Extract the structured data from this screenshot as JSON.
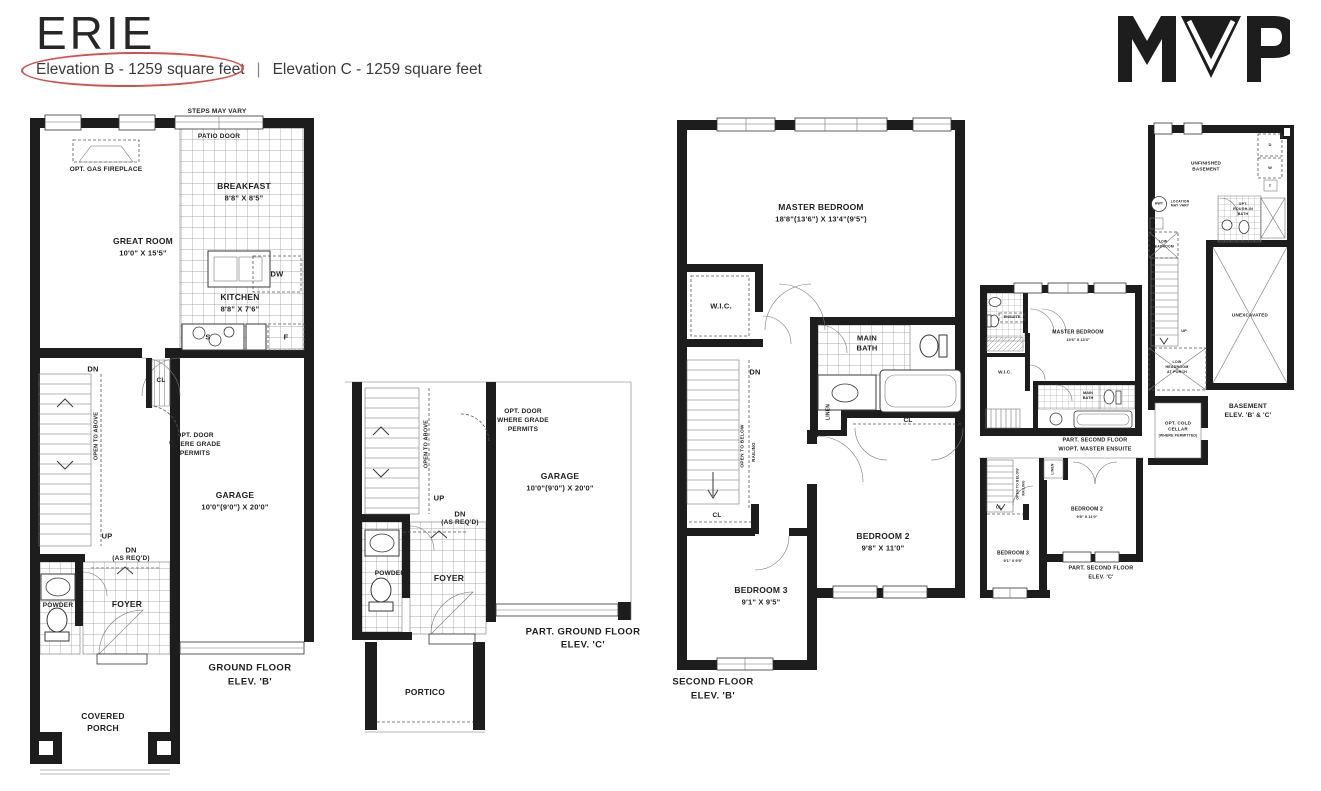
{
  "header": {
    "title": "ERIE",
    "elevation_b": "Elevation B - 1259 square feet",
    "divider": "|",
    "elevation_c": "Elevation C - 1259 square feet"
  },
  "logo": {
    "text": "MVP"
  },
  "common": {
    "dn": "DN",
    "up": "UP",
    "cl": "CL",
    "dw": "DW",
    "f": "F",
    "s": "S",
    "as_reqd": "(AS REQ'D)",
    "open_to_above": "OPEN TO ABOVE",
    "open_to_below": "OPEN TO BELOW",
    "railing": "RAILING",
    "linen": "LINEN",
    "powder": "POWDER",
    "foyer": "FOYER",
    "wic": "W.I.C.",
    "opt_door_1": "OPT. DOOR",
    "opt_door_2": "WHERE GRADE",
    "opt_door_3": "PERMITS",
    "garage": "GARAGE",
    "garage_dims": "10'0\"(9'0\") X 20'0\"",
    "main": "MAIN",
    "bath": "BATH",
    "bedroom2": "BEDROOM 2",
    "bedroom2_dims": "9'8\" X 11'0\"",
    "bedroom3": "BEDROOM 3",
    "bedroom3_dims": "9'1\" X 9'5\""
  },
  "plans": {
    "ground_b": {
      "steps_may_vary": "STEPS MAY VARY",
      "patio_door": "PATIO DOOR",
      "opt_gas_fireplace": "OPT. GAS FIREPLACE",
      "breakfast": "BREAKFAST",
      "breakfast_dims": "8'8\" X 8'5\"",
      "great_room": "GREAT ROOM",
      "great_room_dims": "10'0\" X 15'5\"",
      "kitchen": "KITCHEN",
      "kitchen_dims": "8'8\" X 7'6\"",
      "covered_1": "COVERED",
      "covered_2": "PORCH",
      "caption_1": "GROUND FLOOR",
      "caption_2": "ELEV. 'B'"
    },
    "part_ground_c": {
      "portico": "PORTICO",
      "caption_1": "PART. GROUND FLOOR",
      "caption_2": "ELEV. 'C'"
    },
    "second_b": {
      "master": "MASTER BEDROOM",
      "master_dims": "18'8\"(13'6\") X 13'4\"(9'5\")",
      "caption_1": "SECOND FLOOR",
      "caption_2": "ELEV. 'B'"
    },
    "part_second_ens": {
      "ensuite": "ENSUITE",
      "glass_shower": "GLASS SHOWER",
      "master": "MASTER BEDROOM",
      "master_dims": "13'6\" X 13'4\"",
      "caption_1": "PART. SECOND FLOOR",
      "caption_2": "W/OPT. MASTER ENSUITE"
    },
    "part_second_c": {
      "caption_1": "PART. SECOND FLOOR",
      "caption_2": "ELEV. 'C'"
    },
    "basement": {
      "unfinished_1": "UNFINISHED",
      "unfinished_2": "BASEMENT",
      "hwt": "HWT",
      "location_1": "LOCATION",
      "location_2": "MAY VARY",
      "d": "D",
      "w": "W",
      "t": "T",
      "rough_1": "OPT.",
      "rough_2": "ROUGH-IN",
      "rough_3": "BATH",
      "low_1": "LOW",
      "low_2": "HEADROOM",
      "at_porch": "AT PORCH",
      "unexcavated": "UNEXCAVATED",
      "cold_1": "OPT. COLD",
      "cold_2": "CELLAR",
      "cold_3": "(WHERE PERMITTED)",
      "caption_1": "BASEMENT",
      "caption_2": "ELEV. 'B' & 'C'"
    }
  }
}
